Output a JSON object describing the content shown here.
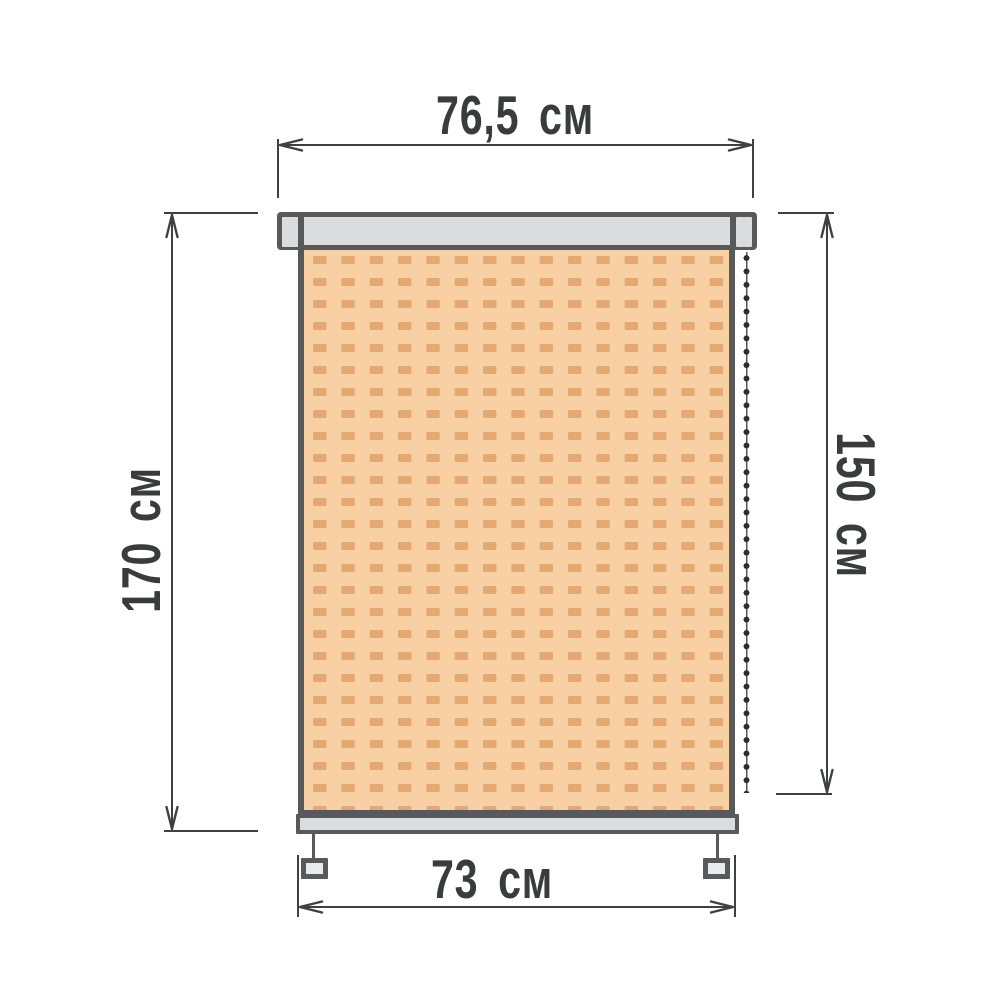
{
  "diagram": {
    "type": "roller-blind-dimension-diagram",
    "labels": {
      "top_width": "76,5 см",
      "left_height": "170 см",
      "right_height": "150 см",
      "bottom_width": "73 см"
    },
    "colors": {
      "background": "#FFFFFF",
      "outline": "#58595B",
      "cassette_fill": "#DBDCDD",
      "fabric": "#F9CFA4",
      "fabric_dash": "#E4A973",
      "chain_bead": "#2E2E30",
      "dimension_line": "#3F4041",
      "label_text": "#3A3B3C"
    }
  }
}
